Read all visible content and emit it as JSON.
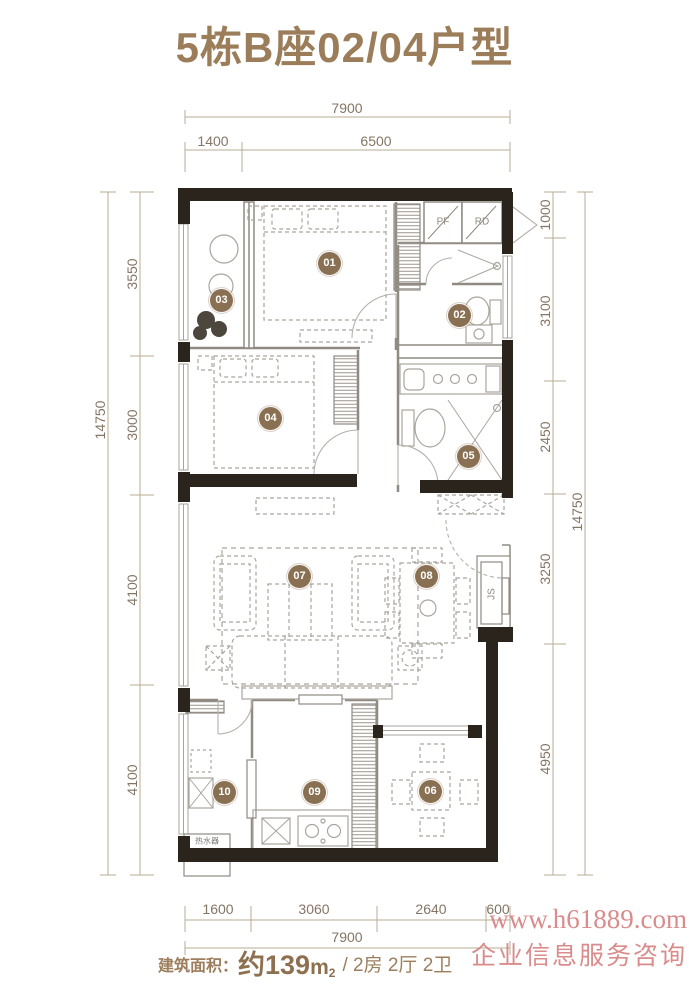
{
  "title": "5栋B座02/04户型",
  "dims": {
    "top": {
      "total": "7900",
      "segments": [
        "1400",
        "6500"
      ]
    },
    "bottom": {
      "total": "7900",
      "segments": [
        "1600",
        "3060",
        "2640",
        "600"
      ]
    },
    "left": {
      "total": "14750",
      "segments": [
        "3550",
        "3000",
        "4100",
        "4100"
      ]
    },
    "right": {
      "total": "14750",
      "segments": [
        "1000",
        "3100",
        "2450",
        "3250",
        "4950"
      ]
    }
  },
  "rooms": {
    "r01": "01",
    "r02": "02",
    "r03": "03",
    "r04": "04",
    "r05": "05",
    "r06": "06",
    "r07": "07",
    "r08": "08",
    "r09": "09",
    "r10": "10"
  },
  "plan_labels": {
    "pf": "PF",
    "rd": "RD",
    "js": "JS",
    "water_heater": "热水器"
  },
  "footer": {
    "area_label": "建筑面积：",
    "area_value": "约139",
    "area_unit": "m",
    "area_sup": "2",
    "layout_info": "/ 2房 2厅 2卫"
  },
  "watermark": {
    "line1": "www.h61889.com",
    "line2": "企业信息服务咨询"
  },
  "colors": {
    "accent": "#9b7d5a",
    "wall": "#2a241c",
    "badge": "#8a7052",
    "dim_text": "#847565",
    "watermark": "#d67f7f"
  }
}
